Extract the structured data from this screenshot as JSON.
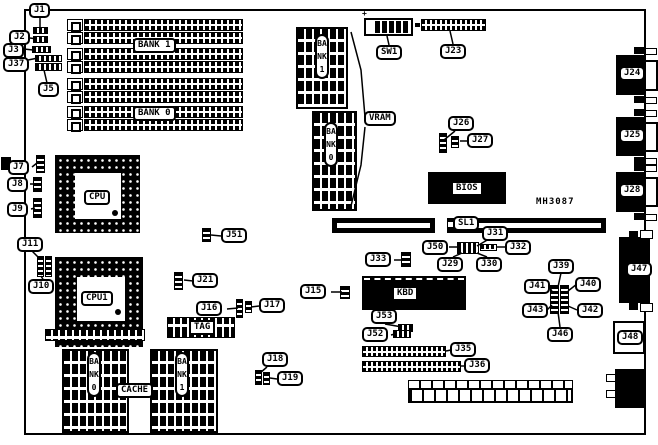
{
  "diagram": {
    "type": "motherboard-layout"
  },
  "annotations": {
    "part_number": "MH3087",
    "sw1_polarity": "+"
  },
  "callouts": {
    "j1": "J1",
    "j2": "J2",
    "j3": "J3",
    "j37": "J37",
    "j5": "J5",
    "j7": "J7",
    "j8": "J8",
    "j9": "J9",
    "j11": "J11",
    "j10": "J10",
    "j51": "J51",
    "j21": "J21",
    "j16": "J16",
    "j17": "J17",
    "j15": "J15",
    "j18": "J18",
    "j19": "J19",
    "j23": "J23",
    "sw1": "SW1",
    "j26": "J26",
    "j27": "J27",
    "sl1": "SL1",
    "j31": "J31",
    "j50": "J50",
    "j32": "J32",
    "j29": "J29",
    "j30": "J30",
    "j33": "J33",
    "j53": "J53",
    "j52": "J52",
    "j35": "J35",
    "j36": "J36",
    "j39": "J39",
    "j40": "J40",
    "j41": "J41",
    "j42": "J42",
    "j43": "J43",
    "j46": "J46",
    "j24": "J24",
    "j25": "J25",
    "j28": "J28",
    "j47": "J47",
    "j48": "J48"
  },
  "chips": {
    "cpu": "CPU",
    "cpu1": "CPU1",
    "bios": "BIOS",
    "kbd": "KBD",
    "tag": "TAG",
    "vram": "VRAM",
    "cache": "CACHE"
  },
  "memory": {
    "simm_bank_1": "BANK 1",
    "simm_bank_0": "BANK 0",
    "vram_bank_1": "BANK1",
    "vram_bank_0": "BANK0",
    "cache_bank_0": "BANK0",
    "cache_bank_1": "BANK1"
  }
}
